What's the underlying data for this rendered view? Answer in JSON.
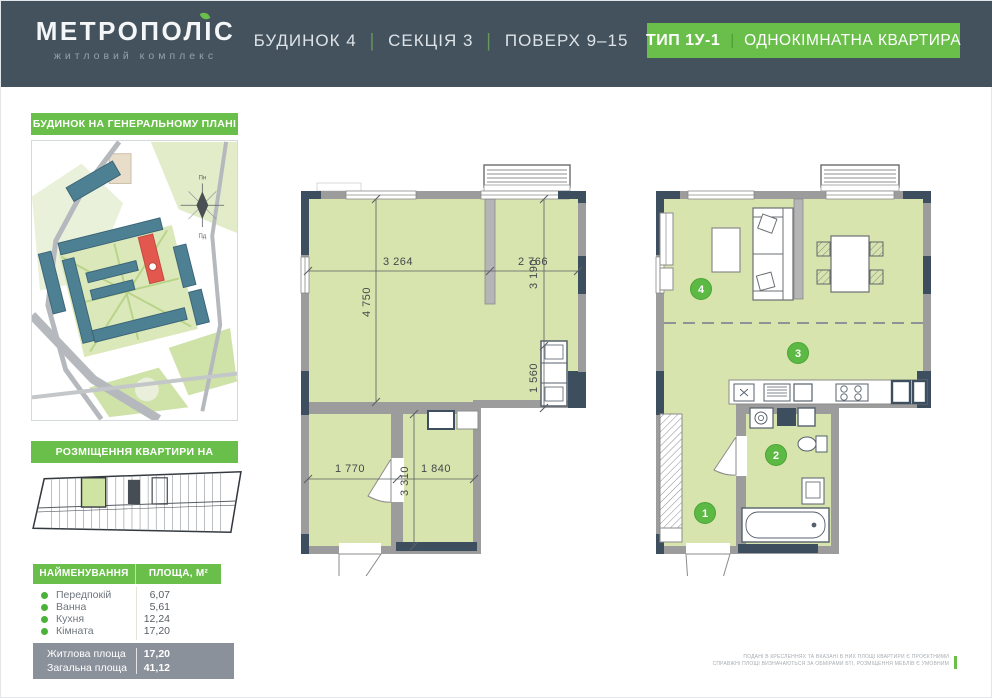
{
  "header": {
    "logo_title": "МЕТРОПОЛІС",
    "logo_subtitle": "житловий комплекс",
    "building": "БУДИНОК 4",
    "section": "СЕКЦІЯ 3",
    "floor": "ПОВЕРХ 9–15",
    "separator": "|",
    "type_badge": "ТИП 1У-1",
    "type_name": "ОДНОКІМНАТНА КВАРТИРА"
  },
  "sidebar": {
    "masterplan_label": "БУДИНОК НА ГЕНЕРАЛЬНОМУ ПЛАНІ",
    "floorplate_label": "РОЗМІЩЕННЯ КВАРТИРИ НА ПОВЕРСІ",
    "compass": {
      "north": "Пн",
      "south": "Пд"
    },
    "table": {
      "col_name": "НАЙМЕНУВАННЯ",
      "col_area": "ПЛОЩА, М²",
      "rows": [
        {
          "label": "Передпокій",
          "value": "6,07"
        },
        {
          "label": "Ванна",
          "value": "5,61"
        },
        {
          "label": "Кухня",
          "value": "12,24"
        },
        {
          "label": "Кімната",
          "value": "17,20"
        }
      ],
      "summary": [
        {
          "label": "Житлова площа",
          "value": "17,20"
        },
        {
          "label": "Загальна площа",
          "value": "41,12"
        }
      ]
    }
  },
  "plan": {
    "dims": {
      "top_left": "3 264",
      "top_right": "2 766",
      "left": "4 750",
      "right_upper": "3 190",
      "right_lower": "1 560",
      "bottom_left": "1 770",
      "bottom_right": "1 840",
      "bottom_vertical": "3 310"
    },
    "markers": {
      "hall": "1",
      "bath": "2",
      "kitchen": "3",
      "room": "4"
    }
  },
  "footer": {
    "disclaimer_line1": "ПОДАНІ В КРЕСЛЕННЯХ ТА ВКАЗАНІ В НИХ ПЛОЩІ КВАРТИРИ Є ПРОЄКТНИМИ",
    "disclaimer_line2": "СПРАВЖНІ ПЛОЩІ ВИЗНАЧАЮТЬСЯ ЗА ОБМІРАМИ БТІ, РОЗМІЩЕННЯ МЕБЛІВ Є УМОВНИМ"
  },
  "colors": {
    "accent_green": "#6abf4b",
    "header_navy": "#44525e",
    "wall_gray": "#9c9c9c",
    "corner_navy": "#3d4f5f",
    "room_fill": "#d7e4ad",
    "summary_gray": "#8b919b",
    "highlight_red": "#e2574e"
  }
}
